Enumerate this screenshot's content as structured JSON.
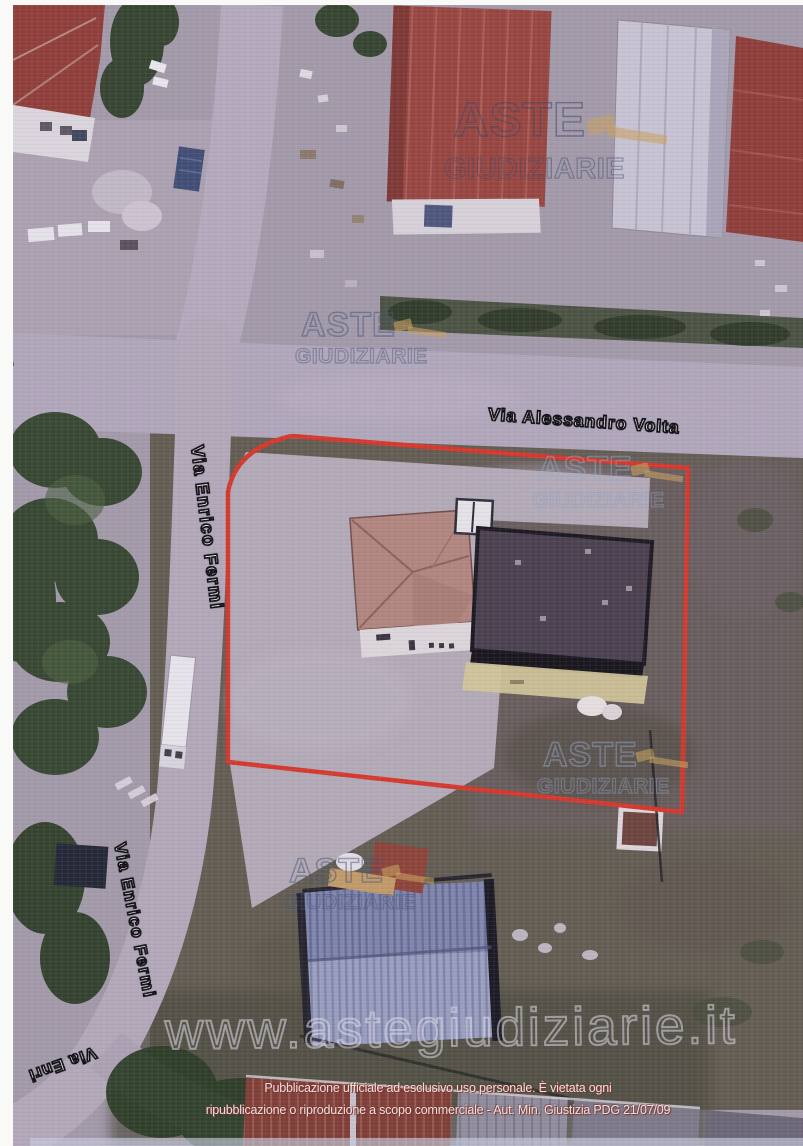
{
  "streets": {
    "volta": "Via Alessandro Volta",
    "fermi_upper": "Via Enrico Fermi",
    "fermi_lower": "Via Enrico Fermi",
    "enri_cut": "Via Enri",
    "a_cut": "a"
  },
  "watermark": {
    "line1": "ASTE",
    "line2": "GIUDIZIARIE",
    "url": "www.astegiudiziarie.it"
  },
  "disclaimer": {
    "line1": "Pubblicazione ufficiale ad esclusivo uso personale. È vietata ogni",
    "line2": "ripubblicazione o riproduzione a scopo commerciale - Aut. Min. Giustizia PDG 21/07/09"
  },
  "colors": {
    "property_boundary": "#d63426",
    "watermark_outline": "#3e5070",
    "gavel": "#c9a25c",
    "red_roof": "#96423a",
    "dark_roof": "#453d4a",
    "blue_roof": "#7e85ab"
  }
}
